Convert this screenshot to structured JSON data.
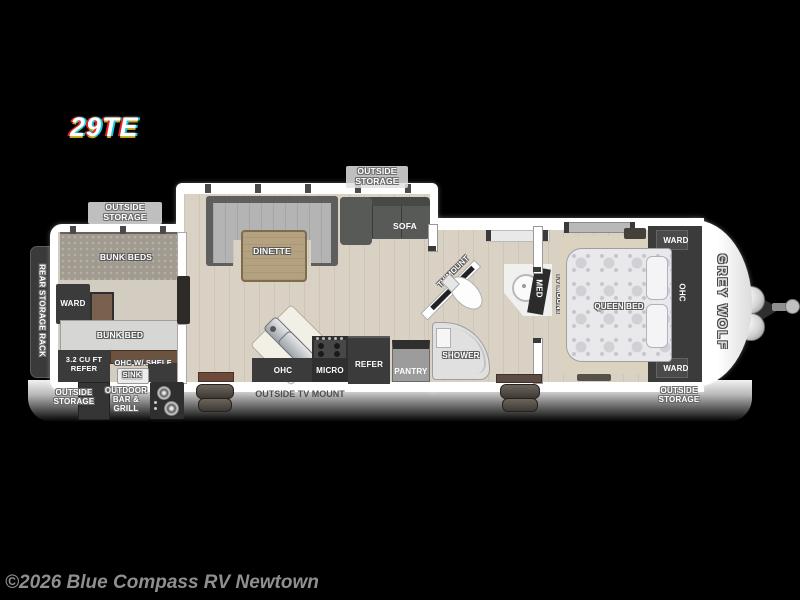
{
  "header": {
    "model": "29TE"
  },
  "footer": {
    "copyright": "©2026 Blue Compass RV Newtown"
  },
  "exterior": {
    "rear_storage_rack": "REAR STORAGE RACK",
    "outside_storage_top_left": "OUTSIDE STORAGE",
    "outside_storage_top_center": "OUTSIDE STORAGE",
    "outside_storage_bottom_left": "OUTSIDE STORAGE",
    "outside_storage_bottom_right": "OUTSIDE STORAGE",
    "outside_tv_mount": "OUTSIDE TV MOUNT",
    "outdoor_bar_grill": "OUTDOOR BAR & GRILL",
    "brand": "GREY WOLF"
  },
  "bunk_room": {
    "bunk_beds": "BUNK BEDS",
    "ward": "WARD",
    "bunk_bed": "BUNK BED",
    "mini_refer": "3.2 CU FT REFER",
    "ohc_shelf": "OHC W/ SHELF",
    "sink": "SINK"
  },
  "living_area": {
    "dinette": "DINETTE",
    "sofa": "SOFA"
  },
  "kitchen": {
    "ohc": "OHC",
    "micro": "MICRO",
    "refer": "REFER",
    "pantry": "PANTRY"
  },
  "bathroom": {
    "tv_mount": "TV MOUNT",
    "shower": "SHOWER",
    "med": "MED"
  },
  "bedroom": {
    "tv_mount": "TV MOUNT",
    "queen_bed": "QUEEN BED",
    "ward_top": "WARD",
    "ohc": "OHC",
    "ward_bottom": "WARD"
  },
  "colors": {
    "background": "#000000",
    "shell": "#ffffff",
    "floor_wood": "#d9d1c3",
    "cabinet_dark": "#3b3b3b",
    "copyright_gray": "#8f8f8f"
  }
}
